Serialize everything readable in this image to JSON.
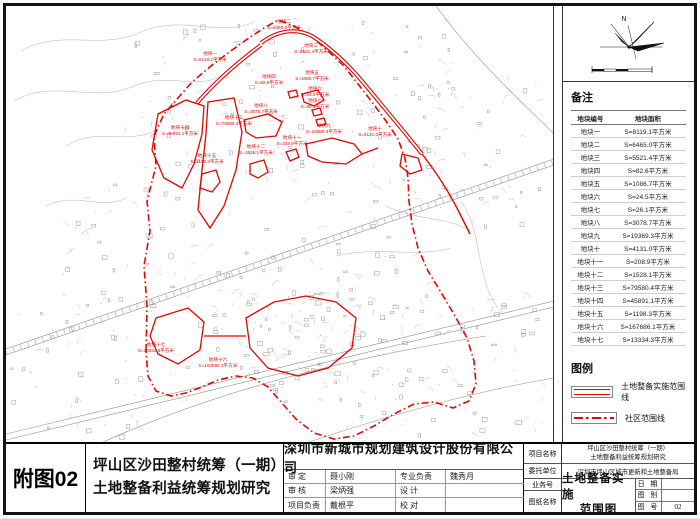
{
  "colors": {
    "boundary_red": "#e10600",
    "map_line_grey": "#9b9b9b",
    "frame_black": "#141414"
  },
  "figure_label": "附图02",
  "project": {
    "title_line1": "坪山区沙田整村统筹（一期）",
    "title_line2": "土地整备利益统筹规划研究"
  },
  "company": "深圳市新城市规划建筑设计股份有限公司",
  "signoff": {
    "shen_ding_label": "审  定",
    "shen_ding": "聂小刚",
    "shen_he_label": "审  核",
    "shen_he": "梁炳强",
    "xiangmu_fuze_label": "项目负责",
    "xiangmu_fuze": "戴根平",
    "zhuanye_fuze_label": "专业负责",
    "zhuanye_fuze": "魏秀月",
    "sheji_label": "设  计",
    "sheji": "",
    "jiaodui_label": "校  对",
    "jiaodui": ""
  },
  "title_block_right": {
    "project_name_label": "项目名称",
    "client_label": "委托单位",
    "client": "深圳市坪山区城市更新和土地整备局",
    "job_no_label": "业务号",
    "job_no": "",
    "sheet_name_label": "图纸名称",
    "sheet_name_line1": "土地整备实施",
    "sheet_name_line2": "范围图",
    "date_label": "日 期",
    "date": "",
    "sheet_type_label": "图 别",
    "sheet_type": "",
    "sheet_no_label": "图 号",
    "sheet_no": "02"
  },
  "right_panel": {
    "north_label": "N",
    "notes_title": "备注",
    "table_headers": {
      "col1": "地块编号",
      "col2": "地块面积"
    },
    "legend_title": "图例",
    "legend": [
      {
        "label": "土地整备实施范围线",
        "style": "solid-double"
      },
      {
        "label": "社区范围线",
        "style": "dash-dot"
      }
    ]
  },
  "plots": [
    {
      "name": "地块一",
      "area": "S=8119.1平方米",
      "x": 204,
      "y": 51
    },
    {
      "name": "地块二",
      "area": "S=6465.0平方米",
      "x": 278,
      "y": 19
    },
    {
      "name": "地块三",
      "area": "S=5521.4平方米",
      "x": 305,
      "y": 43
    },
    {
      "name": "地块四",
      "area": "S=82.6平方米",
      "x": 263,
      "y": 74
    },
    {
      "name": "地块五",
      "area": "S=1086.7平方米",
      "x": 306,
      "y": 70
    },
    {
      "name": "地块六",
      "area": "S=24.5平方米",
      "x": 309,
      "y": 86
    },
    {
      "name": "地块七",
      "area": "S=26.1平方米",
      "x": 309,
      "y": 98
    },
    {
      "name": "地块八",
      "area": "S=3078.7平方米",
      "x": 255,
      "y": 103
    },
    {
      "name": "地块九",
      "area": "S=19369.3平方米",
      "x": 318,
      "y": 123
    },
    {
      "name": "地块十",
      "area": "S=4131.0平方米",
      "x": 369,
      "y": 126
    },
    {
      "name": "地块十一",
      "area": "S=208.9平方米",
      "x": 286,
      "y": 135
    },
    {
      "name": "地块十二",
      "area": "S=1528.1平方米",
      "x": 250,
      "y": 144
    },
    {
      "name": "地块十三",
      "area": "S=79580.4平方米",
      "x": 228,
      "y": 115
    },
    {
      "name": "地块十四",
      "area": "S=45891.1平方米",
      "x": 174,
      "y": 125
    },
    {
      "name": "地块十五",
      "area": "S=1198.3平方米",
      "x": 201,
      "y": 153
    },
    {
      "name": "地块十六",
      "area": "S=167686.1平方米",
      "x": 212,
      "y": 357
    },
    {
      "name": "地块十七",
      "area": "S=13334.3平方米",
      "x": 150,
      "y": 342
    }
  ]
}
